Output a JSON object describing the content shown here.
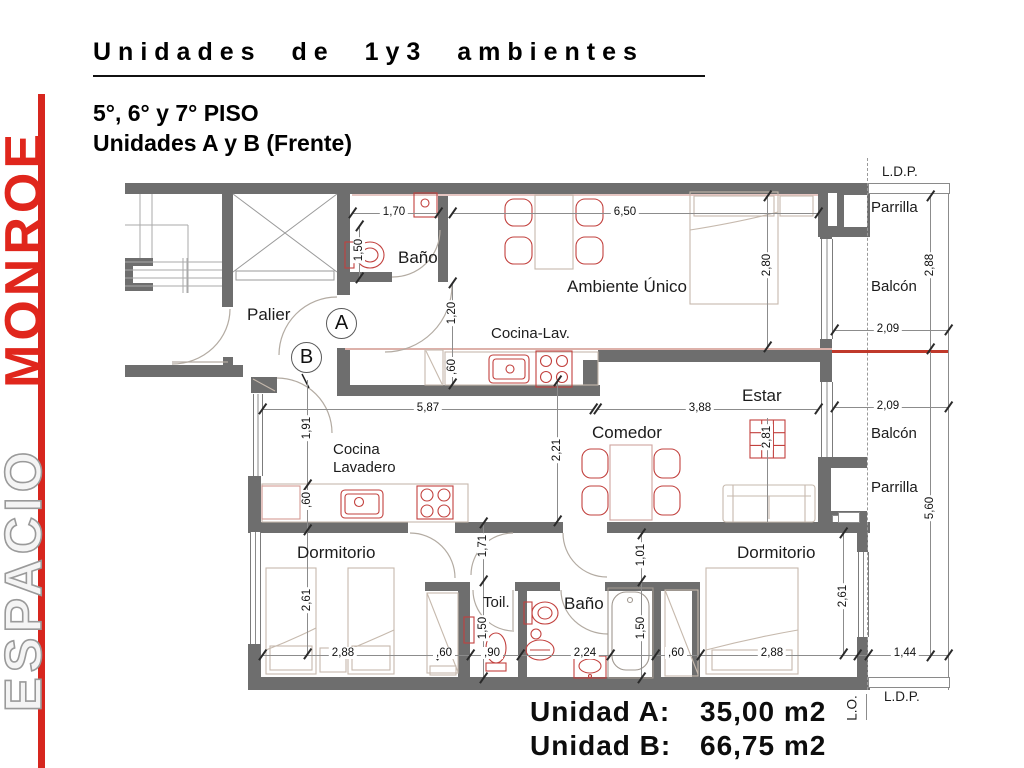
{
  "brand": {
    "espacio": "ESPACIO",
    "monroe": "MONROE"
  },
  "header": {
    "title": "Unidades de 1y3 ambientes",
    "subtitle1": "5°, 6° y 7° PISO",
    "subtitle2": "Unidades A y B (Frente)"
  },
  "footer": {
    "unit_a_label": "Unidad A:",
    "unit_a_area": "35,00 m2",
    "unit_b_label": "Unidad B:",
    "unit_b_area": "66,75 m2"
  },
  "markers": {
    "unit_a": "A",
    "unit_b": "B"
  },
  "rooms": {
    "bano": "Baño",
    "palier": "Palier",
    "ambiente_unico": "Ambiente Único",
    "cocina_lav": "Cocina-Lav.",
    "estar": "Estar",
    "comedor": "Comedor",
    "cocina": "Cocina",
    "lavadero": "Lavadero",
    "dormitorio": "Dormitorio",
    "toilette": "Toil.",
    "balcon": "Balcón",
    "parrilla": "Parrilla",
    "ldp": "L.D.P.",
    "lo": "L.O."
  },
  "dims": {
    "d170": "1,70",
    "d150": "1,50",
    "d650": "6,50",
    "d280": "2,80",
    "d288": "2,88",
    "d209": "2,09",
    "d120": "1,20",
    "d60": ",60",
    "d587": "5,87",
    "d388": "3,88",
    "d191": "1,91",
    "d221": "2,21",
    "d281": "2,81",
    "d101": "1,01",
    "d171": "1,71",
    "d261": "2,61",
    "d90": ",90",
    "d224": "2,24",
    "d144": "1,44",
    "d560": "5,60"
  },
  "colors": {
    "brand_red": "#d7261e",
    "wall_gray": "#6e6e6e",
    "fixture_red": "#c2413e",
    "furniture_tan": "#c6b9ad"
  }
}
